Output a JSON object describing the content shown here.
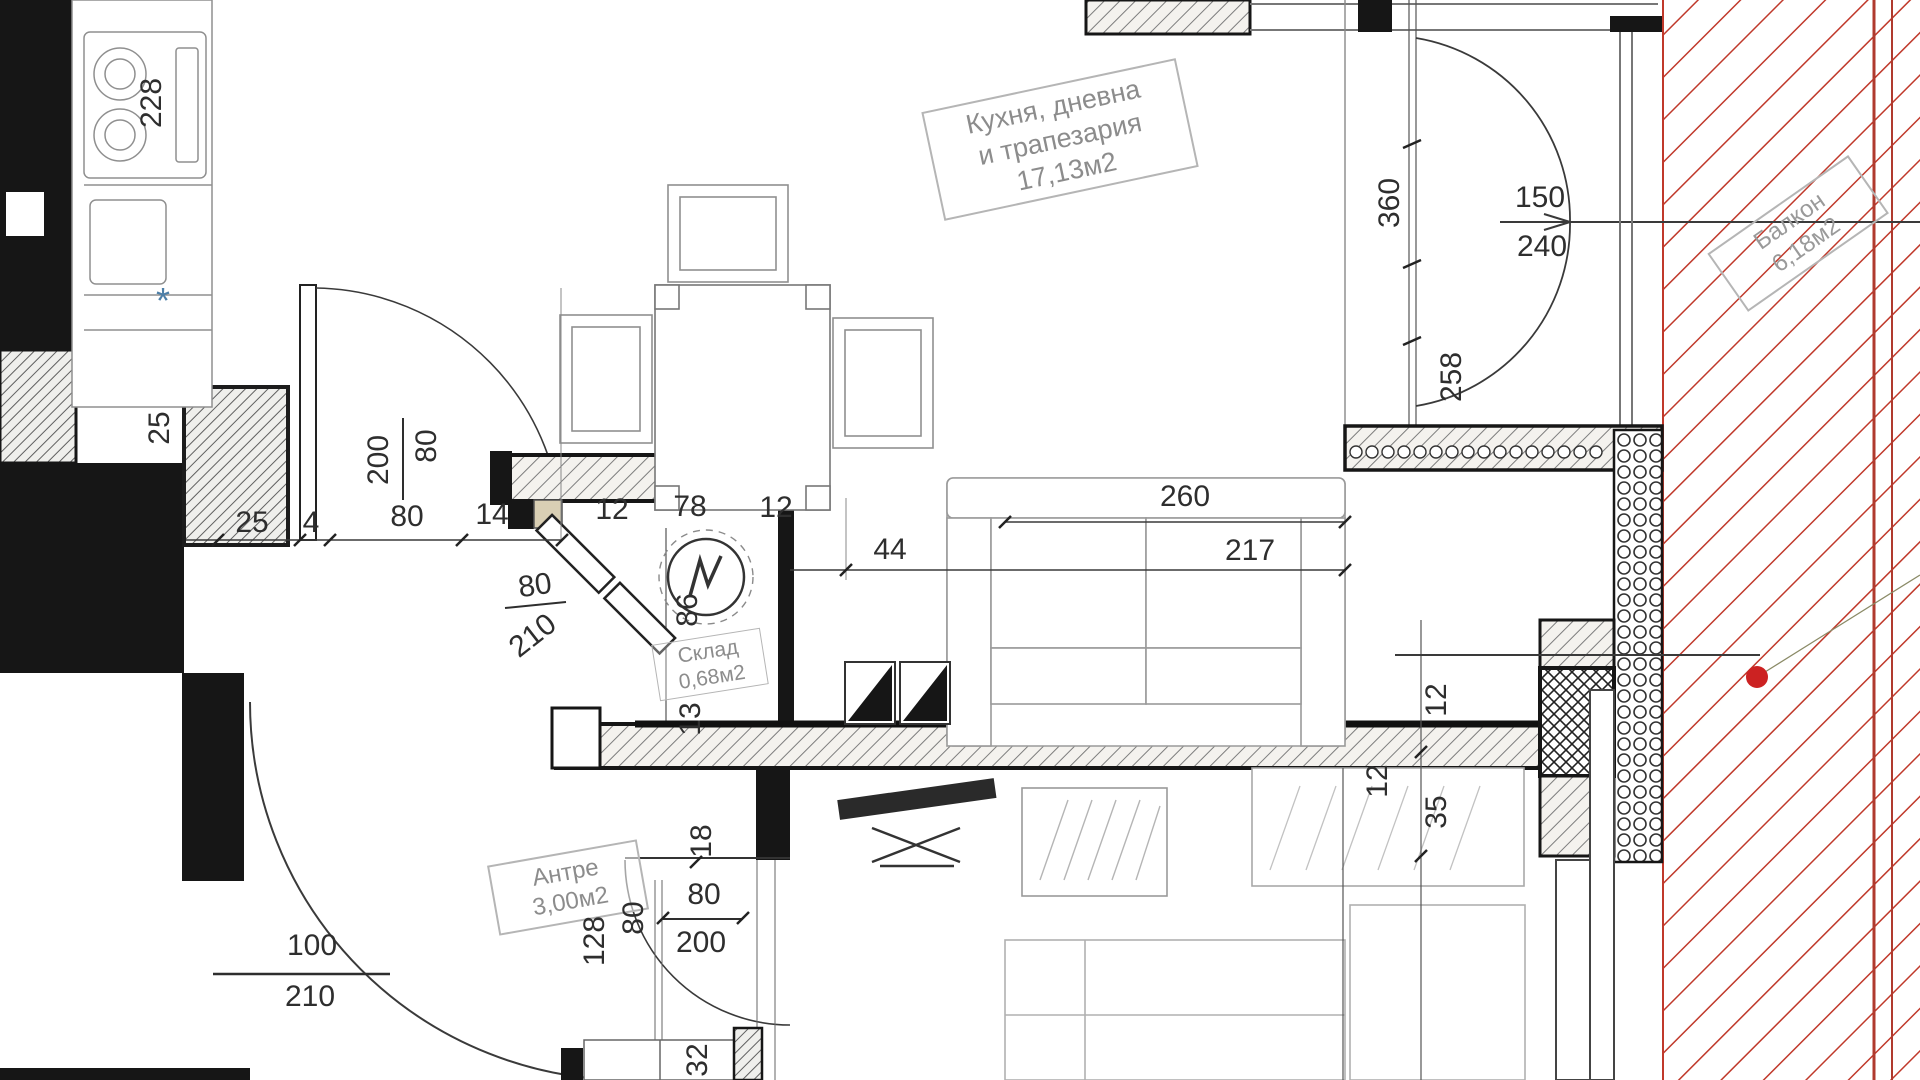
{
  "plan_type": "apartment-floor-plan",
  "colors": {
    "wall_black": "#161616",
    "line_dark": "#2e2e2e",
    "hatch_gray": "#7d7d7d",
    "furniture_gray": "#9a9a9a",
    "light_gray": "#c4c4c4",
    "balcony_red": "#c0392b",
    "red_dot": "#cc2222",
    "label_gray": "#8c8c8c",
    "star_blue": "#4d7fa8",
    "threshold_tan": "#d9cfb4"
  },
  "rooms": [
    {
      "id": "kitchen-living-dining",
      "lines": [
        "Кухня, дневна",
        "и трапезария"
      ],
      "area": "17,13м2"
    },
    {
      "id": "antre",
      "lines": [
        "Антре"
      ],
      "area": "3,00м2"
    },
    {
      "id": "sklad",
      "lines": [
        "Склад"
      ],
      "area": "0,68м2"
    },
    {
      "id": "balcony",
      "lines": [
        "Балкон"
      ],
      "area": "6,18м2"
    }
  ],
  "dimensions": [
    {
      "t": "228",
      "x": 152,
      "y": 103,
      "r": -90
    },
    {
      "t": "*",
      "x": 163,
      "y": 301,
      "r": 0,
      "c": "#4d7fa8",
      "s": 36
    },
    {
      "t": "25",
      "x": 160,
      "y": 428,
      "r": -90
    },
    {
      "t": "25",
      "x": 252,
      "y": 523,
      "r": 0
    },
    {
      "t": "4",
      "x": 311,
      "y": 523,
      "r": 0
    },
    {
      "t": "80",
      "x": 407,
      "y": 517,
      "r": 0
    },
    {
      "t": "14",
      "x": 492,
      "y": 515,
      "r": 0
    },
    {
      "t": "12",
      "x": 612,
      "y": 510,
      "r": 0
    },
    {
      "t": "78",
      "x": 690,
      "y": 507,
      "r": 0
    },
    {
      "t": "12",
      "x": 776,
      "y": 508,
      "r": 0
    },
    {
      "t": "80",
      "x": 427,
      "y": 446,
      "r": -90
    },
    {
      "t": "200",
      "x": 379,
      "y": 460,
      "r": -90
    },
    {
      "t": "80",
      "x": 535,
      "y": 586,
      "r": -8
    },
    {
      "t": "210",
      "x": 533,
      "y": 636,
      "r": -38
    },
    {
      "t": "44",
      "x": 890,
      "y": 550,
      "r": 0
    },
    {
      "t": "260",
      "x": 1185,
      "y": 497,
      "r": 0
    },
    {
      "t": "217",
      "x": 1250,
      "y": 551,
      "r": 0
    },
    {
      "t": "360",
      "x": 1390,
      "y": 203,
      "r": -90
    },
    {
      "t": "258",
      "x": 1452,
      "y": 377,
      "r": -90
    },
    {
      "t": "150",
      "x": 1540,
      "y": 198,
      "r": 0
    },
    {
      "t": "240",
      "x": 1542,
      "y": 247,
      "r": 0
    },
    {
      "t": "86",
      "x": 688,
      "y": 610,
      "r": -90
    },
    {
      "t": "13",
      "x": 691,
      "y": 719,
      "r": -90
    },
    {
      "t": "12",
      "x": 1437,
      "y": 700,
      "r": -90
    },
    {
      "t": "12",
      "x": 1378,
      "y": 781,
      "r": -90
    },
    {
      "t": "35",
      "x": 1437,
      "y": 812,
      "r": -90
    },
    {
      "t": "18",
      "x": 702,
      "y": 841,
      "r": -90
    },
    {
      "t": "128",
      "x": 595,
      "y": 941,
      "r": -90
    },
    {
      "t": "80",
      "x": 634,
      "y": 918,
      "r": -90
    },
    {
      "t": "80",
      "x": 704,
      "y": 895,
      "r": 0
    },
    {
      "t": "200",
      "x": 701,
      "y": 943,
      "r": 0
    },
    {
      "t": "100",
      "x": 312,
      "y": 946,
      "r": 0
    },
    {
      "t": "210",
      "x": 310,
      "y": 997,
      "r": 0
    },
    {
      "t": "32",
      "x": 698,
      "y": 1060,
      "r": -90
    }
  ]
}
